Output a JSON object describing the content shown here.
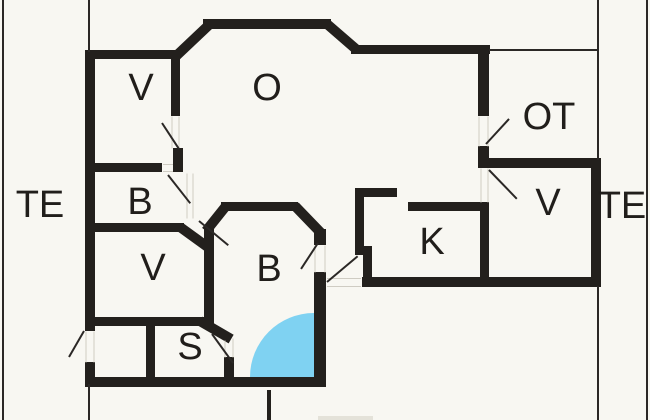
{
  "plan": {
    "style": {
      "bg": "#f8f7f2",
      "wall_color": "#23201d",
      "thin_color": "#2b2826",
      "gap_color": "#cfccc3",
      "label_color": "#211e1b",
      "wall_thickness": 10,
      "label_font_size": 38
    },
    "rooms": [
      {
        "id": "v-top-left",
        "label": "V",
        "x": 141,
        "y": 88
      },
      {
        "id": "o-living",
        "label": "O",
        "x": 267,
        "y": 88
      },
      {
        "id": "ot-terrace",
        "label": "OT",
        "x": 549,
        "y": 117
      },
      {
        "id": "te-left",
        "label": "TE",
        "x": 40,
        "y": 205
      },
      {
        "id": "b-small",
        "label": "B",
        "x": 140,
        "y": 202
      },
      {
        "id": "v-lower-left",
        "label": "V",
        "x": 153,
        "y": 268
      },
      {
        "id": "b-center",
        "label": "B",
        "x": 269,
        "y": 269
      },
      {
        "id": "k-kitchen",
        "label": "K",
        "x": 432,
        "y": 242
      },
      {
        "id": "v-right",
        "label": "V",
        "x": 548,
        "y": 203
      },
      {
        "id": "te-right",
        "label": "TE",
        "x": 622,
        "y": 206
      },
      {
        "id": "s-room",
        "label": "S",
        "x": 190,
        "y": 347
      }
    ],
    "walls": [
      {
        "x": 85,
        "y": 50,
        "w": 10,
        "h": 281
      },
      {
        "x": 85,
        "y": 362,
        "w": 10,
        "h": 20
      },
      {
        "x": 85,
        "y": 50,
        "w": 95,
        "h": 9
      },
      {
        "x": 203,
        "y": 19,
        "w": 128,
        "h": 10
      },
      {
        "x": 351,
        "y": 45,
        "w": 139,
        "h": 9
      },
      {
        "x": 478,
        "y": 50,
        "w": 11,
        "h": 66
      },
      {
        "x": 478,
        "y": 146,
        "w": 11,
        "h": 22
      },
      {
        "x": 478,
        "y": 158,
        "w": 123,
        "h": 10
      },
      {
        "x": 591,
        "y": 158,
        "w": 10,
        "h": 129
      },
      {
        "x": 362,
        "y": 277,
        "w": 239,
        "h": 10
      },
      {
        "x": 314,
        "y": 229,
        "w": 12,
        "h": 16
      },
      {
        "x": 314,
        "y": 272,
        "w": 12,
        "h": 112
      },
      {
        "x": 85,
        "y": 377,
        "w": 241,
        "h": 10
      },
      {
        "x": 95,
        "y": 163,
        "w": 67,
        "h": 9
      },
      {
        "x": 171,
        "y": 55,
        "w": 9,
        "h": 61
      },
      {
        "x": 173,
        "y": 148,
        "w": 10,
        "h": 24
      },
      {
        "x": 95,
        "y": 223,
        "w": 89,
        "h": 9
      },
      {
        "x": 204,
        "y": 228,
        "w": 10,
        "h": 97
      },
      {
        "x": 221,
        "y": 202,
        "w": 77,
        "h": 9
      },
      {
        "x": 355,
        "y": 188,
        "w": 42,
        "h": 9
      },
      {
        "x": 355,
        "y": 188,
        "w": 9,
        "h": 66
      },
      {
        "x": 355,
        "y": 246,
        "w": 17,
        "h": 9
      },
      {
        "x": 363,
        "y": 246,
        "w": 9,
        "h": 41
      },
      {
        "x": 408,
        "y": 202,
        "w": 81,
        "h": 9
      },
      {
        "x": 480,
        "y": 202,
        "w": 9,
        "h": 85
      },
      {
        "x": 85,
        "y": 317,
        "w": 120,
        "h": 9
      },
      {
        "x": 146,
        "y": 323,
        "w": 9,
        "h": 62
      },
      {
        "x": 224,
        "y": 357,
        "w": 10,
        "h": 25
      },
      {
        "x": 267,
        "y": 390,
        "w": 4,
        "h": 30
      }
    ],
    "bevels": [
      {
        "x1": 174,
        "y1": 58,
        "x2": 210,
        "y2": 24
      },
      {
        "x1": 327,
        "y1": 24,
        "x2": 357,
        "y2": 50
      },
      {
        "x1": 206,
        "y1": 231,
        "x2": 226,
        "y2": 206
      },
      {
        "x1": 295,
        "y1": 206,
        "x2": 321,
        "y2": 233
      },
      {
        "x1": 180,
        "y1": 227,
        "x2": 209,
        "y2": 248
      },
      {
        "x1": 200,
        "y1": 321,
        "x2": 231,
        "y2": 339
      }
    ],
    "thin_lines": [
      {
        "x1": 3,
        "y1": 0,
        "x2": 3,
        "y2": 420
      },
      {
        "x1": 647,
        "y1": 0,
        "x2": 647,
        "y2": 420
      },
      {
        "x1": 89,
        "y1": 0,
        "x2": 89,
        "y2": 52
      },
      {
        "x1": 89,
        "y1": 384,
        "x2": 89,
        "y2": 420
      },
      {
        "x1": 598,
        "y1": 0,
        "x2": 598,
        "y2": 160
      },
      {
        "x1": 598,
        "y1": 286,
        "x2": 598,
        "y2": 420
      },
      {
        "x1": 489,
        "y1": 50,
        "x2": 599,
        "y2": 50
      }
    ],
    "door_leaves": [
      {
        "x1": 162,
        "y1": 123,
        "x2": 179,
        "y2": 149
      },
      {
        "x1": 168,
        "y1": 175,
        "x2": 190,
        "y2": 203
      },
      {
        "x1": 199,
        "y1": 221,
        "x2": 228,
        "y2": 245
      },
      {
        "x1": 318,
        "y1": 243,
        "x2": 301,
        "y2": 269
      },
      {
        "x1": 486,
        "y1": 144,
        "x2": 509,
        "y2": 119
      },
      {
        "x1": 489,
        "y1": 170,
        "x2": 517,
        "y2": 199
      },
      {
        "x1": 327,
        "y1": 282,
        "x2": 358,
        "y2": 256
      },
      {
        "x1": 212,
        "y1": 334,
        "x2": 233,
        "y2": 363
      },
      {
        "x1": 84,
        "y1": 331,
        "x2": 69,
        "y2": 357
      }
    ],
    "gap_marks": [
      {
        "x1": 172,
        "y1": 116,
        "x2": 172,
        "y2": 148
      },
      {
        "x1": 179,
        "y1": 116,
        "x2": 179,
        "y2": 148
      },
      {
        "x1": 163,
        "y1": 164,
        "x2": 173,
        "y2": 164
      },
      {
        "x1": 163,
        "y1": 171,
        "x2": 173,
        "y2": 171
      },
      {
        "x1": 187,
        "y1": 173,
        "x2": 187,
        "y2": 218
      },
      {
        "x1": 193,
        "y1": 173,
        "x2": 193,
        "y2": 218
      },
      {
        "x1": 479,
        "y1": 116,
        "x2": 479,
        "y2": 146
      },
      {
        "x1": 488,
        "y1": 116,
        "x2": 488,
        "y2": 146
      },
      {
        "x1": 315,
        "y1": 245,
        "x2": 315,
        "y2": 272
      },
      {
        "x1": 325,
        "y1": 245,
        "x2": 325,
        "y2": 272
      },
      {
        "x1": 327,
        "y1": 278,
        "x2": 361,
        "y2": 278
      },
      {
        "x1": 327,
        "y1": 286,
        "x2": 361,
        "y2": 286
      },
      {
        "x1": 225,
        "y1": 340,
        "x2": 225,
        "y2": 357
      },
      {
        "x1": 233,
        "y1": 338,
        "x2": 233,
        "y2": 357
      },
      {
        "x1": 86,
        "y1": 331,
        "x2": 86,
        "y2": 362
      },
      {
        "x1": 94,
        "y1": 331,
        "x2": 94,
        "y2": 362
      },
      {
        "x1": 481,
        "y1": 168,
        "x2": 481,
        "y2": 202
      },
      {
        "x1": 488,
        "y1": 168,
        "x2": 488,
        "y2": 202
      }
    ],
    "arc": {
      "x": 250,
      "y": 313,
      "w": 64,
      "h": 64,
      "color": "#7fd2f2"
    },
    "watermark": {
      "x": 318,
      "y": 416,
      "w": 55,
      "h": 4,
      "color": "#e4e2d9"
    }
  }
}
